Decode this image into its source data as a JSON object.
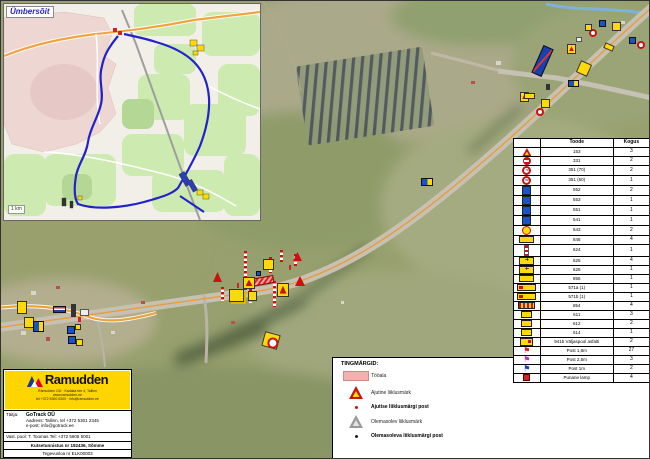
{
  "inset": {
    "label": "Ümbersõit",
    "scale": "1 km"
  },
  "legend_table": {
    "col_product": "Toode",
    "col_count": "Kogus",
    "rows": [
      {
        "icon": "tri",
        "code": "153",
        "count": "3"
      },
      {
        "icon": "noentry",
        "code": "331",
        "count": "2"
      },
      {
        "icon": "speed70",
        "code": "351 (70)",
        "count": "2"
      },
      {
        "icon": "speed50",
        "code": "351 (50)",
        "count": "1"
      },
      {
        "icon": "blue",
        "code": "552",
        "count": "2"
      },
      {
        "icon": "blue",
        "code": "553",
        "count": "1"
      },
      {
        "icon": "blue",
        "code": "551",
        "count": "1"
      },
      {
        "icon": "blue",
        "code": "541",
        "count": "1"
      },
      {
        "icon": "yround",
        "code": "643",
        "count": "2"
      },
      {
        "icon": "board",
        "code": "846",
        "count": "4"
      },
      {
        "icon": "post",
        "code": "624",
        "count": "1"
      },
      {
        "icon": "arrow",
        "code": "625",
        "count": "4"
      },
      {
        "icon": "arrowl",
        "code": "626",
        "count": "1"
      },
      {
        "icon": "board",
        "code": "856",
        "count": "1"
      },
      {
        "icon": "long",
        "code": "571a (1)",
        "count": "1"
      },
      {
        "icon": "long",
        "code": "571b (1)",
        "count": "1"
      },
      {
        "icon": "barrier",
        "code": "854",
        "count": "4"
      },
      {
        "icon": "sm",
        "code": "611",
        "count": "3"
      },
      {
        "icon": "sm",
        "code": "612",
        "count": "2"
      },
      {
        "icon": "sm",
        "code": "614",
        "count": "1"
      },
      {
        "icon": "pair",
        "code": "941b Väljaspool asfalti",
        "count": "2"
      },
      {
        "icon": "flagred",
        "code": "Post 1,8m",
        "count": "27"
      },
      {
        "icon": "flagmag",
        "code": "Post 2,5m",
        "count": "3"
      },
      {
        "icon": "flagblue",
        "code": "Post 1m",
        "count": "2"
      },
      {
        "icon": "lamp",
        "code": "Punane lamp",
        "count": "4"
      }
    ]
  },
  "symbols": {
    "title": "TINGMÄRGID:",
    "items": [
      {
        "icon": "workarea",
        "label": "Tööala",
        "bold": false
      },
      {
        "icon": "temp-sign",
        "label": "Ajutine liiklusmärk",
        "bold": false
      },
      {
        "icon": "temp-post",
        "label": "Ajutise liiklusmärgi post",
        "bold": true
      },
      {
        "icon": "exist-sign",
        "label": "Olemasolev liiklusmärk",
        "bold": false
      },
      {
        "icon": "exist-post",
        "label": "Olemasoleva liiklusmärgi post",
        "bold": true
      }
    ]
  },
  "info": {
    "row1": "Tee nimetus: riigitee nr 5 Pärnu–Rakvere–Sõmeru",
    "row2": "Objekti nimetus: Ajutine liikluskorraldus.",
    "row3": "Asukoht: Riigitee 5 (km 145,6) Tapa vald, Lääne-Viru maakond",
    "notes_title": "Märkused:",
    "note1": "• 941b paigaldatakse tööde ajaks, info T. Toomas tel 5605 5001",
    "note2": "• Tähistatakse öisel ajal",
    "date_label": "Kuupäev",
    "date": "10.03.2025",
    "job_label": "Töö nr",
    "job": "TLT-25-035",
    "sheet_label": "Lehe nr",
    "sheet": "1"
  },
  "company": {
    "name": "Ramudden",
    "addr1": "Ramudden OÜ · Kadaka tee 4, Tallinn",
    "addr2": "www.ramudden.ee",
    "addr3": "tel +372 5300 0000 · info@ramudden.ee",
    "executor_label": "Täitja:",
    "executor": "GoTrack OÜ",
    "executor_line2": "Aadress: Tallinn, tel +372 5301 2345",
    "executor_line3": "e-post: info@gotrack.ee",
    "responsible": "Vast. pool: T. Toomas Tel: +372 5605 5001",
    "cert": "Kutsetunnistus nr 192436, Sõmme",
    "license": "Tegevusloa nr ELK00003"
  },
  "map_markers": [
    {
      "t": "blueboard",
      "x": 536,
      "y": 45,
      "w": 11,
      "h": 30,
      "r": 24
    },
    {
      "t": "yellow",
      "x": 577,
      "y": 61,
      "w": 12,
      "h": 13,
      "r": 24
    },
    {
      "t": "yellowtri",
      "x": 566,
      "y": 43,
      "w": 9,
      "h": 10
    },
    {
      "t": "white",
      "x": 575,
      "y": 36,
      "w": 6,
      "h": 5
    },
    {
      "t": "redcircle",
      "x": 588,
      "y": 28,
      "w": 8,
      "h": 8
    },
    {
      "t": "blue",
      "x": 598,
      "y": 19,
      "w": 7,
      "h": 7
    },
    {
      "t": "yellow",
      "x": 584,
      "y": 23,
      "w": 7,
      "h": 7
    },
    {
      "t": "yellow",
      "x": 611,
      "y": 21,
      "w": 9,
      "h": 9
    },
    {
      "t": "redcircle",
      "x": 636,
      "y": 40,
      "w": 8,
      "h": 8
    },
    {
      "t": "blue",
      "x": 628,
      "y": 36,
      "w": 7,
      "h": 7
    },
    {
      "t": "arrow",
      "x": 603,
      "y": 43,
      "w": 10,
      "h": 6,
      "r": 24
    },
    {
      "t": "bluepair",
      "x": 567,
      "y": 79,
      "w": 11,
      "h": 7
    },
    {
      "t": "yellowtri",
      "x": 519,
      "y": 81,
      "w": 9,
      "h": 10
    },
    {
      "t": "arrow",
      "x": 523,
      "y": 92,
      "w": 11,
      "h": 6
    },
    {
      "t": "redcircle",
      "x": 535,
      "y": 107,
      "w": 8,
      "h": 8
    },
    {
      "t": "yellow",
      "x": 540,
      "y": 98,
      "w": 9,
      "h": 9
    },
    {
      "t": "dark",
      "x": 545,
      "y": 83,
      "w": 4,
      "h": 6
    },
    {
      "t": "bluepair",
      "x": 420,
      "y": 177,
      "w": 12,
      "h": 8
    },
    {
      "t": "postline",
      "x": 243,
      "y": 250,
      "h": 26
    },
    {
      "t": "postline",
      "x": 268,
      "y": 256,
      "h": 16
    },
    {
      "t": "postline",
      "x": 279,
      "y": 249,
      "h": 12
    },
    {
      "t": "postline",
      "x": 293,
      "y": 253,
      "h": 12
    },
    {
      "t": "postline",
      "x": 243,
      "y": 277,
      "h": 12
    },
    {
      "t": "postline",
      "x": 272,
      "y": 280,
      "h": 26
    },
    {
      "t": "postline",
      "x": 220,
      "y": 286,
      "h": 14
    },
    {
      "t": "postline",
      "x": 248,
      "y": 288,
      "h": 14
    },
    {
      "t": "workarea",
      "x": 249,
      "y": 276,
      "w": 24,
      "h": 8,
      "r": -10
    },
    {
      "t": "yellowtri",
      "x": 242,
      "y": 256,
      "w": 12,
      "h": 12
    },
    {
      "t": "yellow",
      "x": 262,
      "y": 258,
      "w": 11,
      "h": 11
    },
    {
      "t": "yellowtri",
      "x": 276,
      "y": 250,
      "w": 12,
      "h": 14
    },
    {
      "t": "redtri",
      "x": 292,
      "y": 251,
      "w": 9,
      "h": 9
    },
    {
      "t": "yellowpair",
      "x": 228,
      "y": 288,
      "w": 15,
      "h": 13
    },
    {
      "t": "yellow",
      "x": 247,
      "y": 290,
      "w": 9,
      "h": 10
    },
    {
      "t": "yellow70",
      "x": 262,
      "y": 286,
      "w": 16,
      "h": 15,
      "r": 15
    },
    {
      "t": "redtri",
      "x": 212,
      "y": 271,
      "w": 9,
      "h": 10
    },
    {
      "t": "redtri",
      "x": 294,
      "y": 275,
      "w": 10,
      "h": 10
    },
    {
      "t": "blue",
      "x": 255,
      "y": 270,
      "w": 5,
      "h": 5
    },
    {
      "t": "yellow",
      "x": 16,
      "y": 300,
      "w": 10,
      "h": 13
    },
    {
      "t": "yellowpair",
      "x": 23,
      "y": 316,
      "w": 10,
      "h": 11
    },
    {
      "t": "bluepair",
      "x": 32,
      "y": 320,
      "w": 11,
      "h": 11
    },
    {
      "t": "blueboard2",
      "x": 52,
      "y": 305,
      "w": 13,
      "h": 7
    },
    {
      "t": "dark",
      "x": 70,
      "y": 303,
      "w": 5,
      "h": 13
    },
    {
      "t": "white",
      "x": 79,
      "y": 308,
      "w": 9,
      "h": 7
    },
    {
      "t": "blue",
      "x": 66,
      "y": 325,
      "w": 8,
      "h": 8
    },
    {
      "t": "yellow",
      "x": 74,
      "y": 323,
      "w": 6,
      "h": 6
    },
    {
      "t": "blue",
      "x": 67,
      "y": 335,
      "w": 8,
      "h": 8
    },
    {
      "t": "yellow",
      "x": 75,
      "y": 338,
      "w": 7,
      "h": 7
    },
    {
      "t": "flag",
      "x": 77,
      "y": 316,
      "w": 3,
      "h": 5
    },
    {
      "t": "flag",
      "x": 236,
      "y": 282,
      "w": 2,
      "h": 5
    },
    {
      "t": "flag",
      "x": 288,
      "y": 264,
      "w": 2,
      "h": 5
    }
  ]
}
